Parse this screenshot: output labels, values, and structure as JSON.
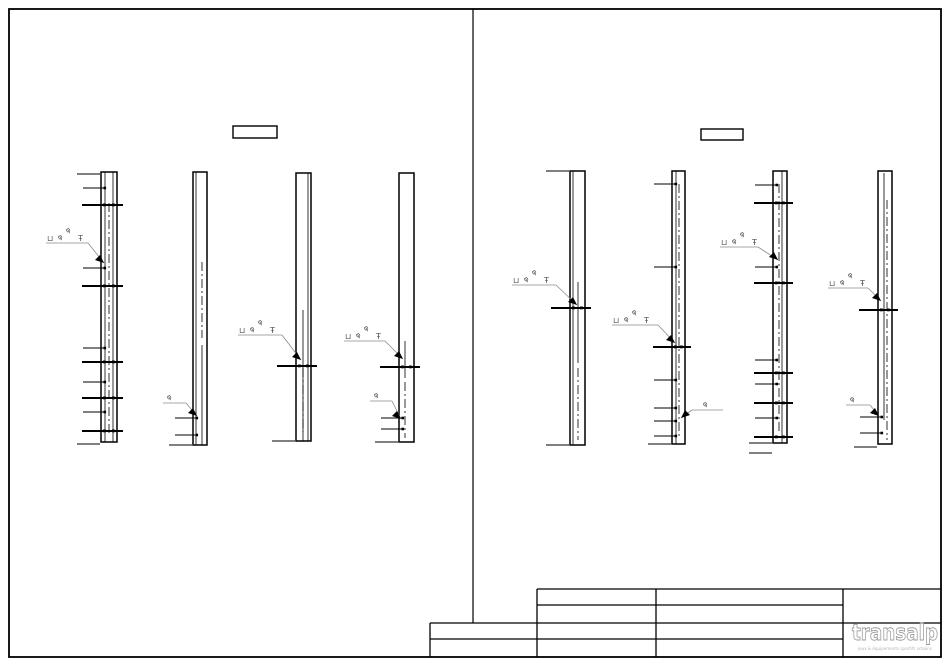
{
  "meta": {
    "sheet_name": "rebar-column-elevation-drawing"
  },
  "canvas": {
    "w": 950,
    "h": 667,
    "bg": "#ffffff",
    "ink": "#000000",
    "leader": "#8a8a8a",
    "symbol": "#565656"
  },
  "border": {
    "x": 9,
    "y": 9,
    "w": 932,
    "h": 648,
    "stroke_w": 1.8
  },
  "divider": {
    "x": 473,
    "y1": 9,
    "y2": 623
  },
  "label_boxes": [
    {
      "x": 233,
      "y": 126,
      "w": 44,
      "h": 12
    },
    {
      "x": 701,
      "y": 129,
      "w": 42,
      "h": 11
    }
  ],
  "columns": [
    {
      "x": 101,
      "w": 16,
      "top": 172,
      "bot": 442,
      "inner": [
        {
          "dx": 4,
          "y1": 172,
          "y2": 442
        },
        {
          "dx": 12,
          "y1": 172,
          "y2": 442
        }
      ],
      "center": {
        "dx": 8,
        "y1": 203,
        "y2": 436
      },
      "ticks": [
        {
          "y": 174,
          "t": "end"
        },
        {
          "y": 188,
          "t": "dot"
        },
        {
          "y": 205,
          "t": "cross"
        },
        {
          "y": 268,
          "t": "dot"
        },
        {
          "y": 286,
          "t": "cross"
        },
        {
          "y": 348,
          "t": "dot"
        },
        {
          "y": 362,
          "t": "cross"
        },
        {
          "y": 382,
          "t": "dot"
        },
        {
          "y": 398,
          "t": "cross"
        },
        {
          "y": 412,
          "t": "dot"
        },
        {
          "y": 431,
          "t": "cross"
        },
        {
          "y": 444,
          "t": "end"
        }
      ]
    },
    {
      "x": 193,
      "w": 14,
      "top": 172,
      "bot": 445,
      "inner": [
        {
          "dx": 3,
          "y1": 172,
          "y2": 445
        },
        {
          "dx": 9,
          "y1": 345,
          "y2": 445
        }
      ],
      "center": {
        "dx": 9,
        "y1": 262,
        "y2": 338
      },
      "ticks": [
        {
          "y": 418,
          "t": "dot"
        },
        {
          "y": 435,
          "t": "dot"
        },
        {
          "y": 445,
          "t": "end"
        }
      ]
    },
    {
      "x": 296,
      "w": 15,
      "top": 173,
      "bot": 441,
      "inner": [
        {
          "dx": 12,
          "y1": 173,
          "y2": 441
        },
        {
          "dx": 7,
          "y1": 310,
          "y2": 441
        }
      ],
      "center": {
        "dx": 7,
        "y1": 368,
        "y2": 432
      },
      "ticks": [
        {
          "y": 366,
          "t": "cross"
        },
        {
          "y": 441,
          "t": "end"
        }
      ]
    },
    {
      "x": 399,
      "w": 15,
      "top": 173,
      "bot": 442,
      "inner": [
        {
          "dx": 6,
          "y1": 341,
          "y2": 378
        }
      ],
      "center": {
        "dx": 6,
        "y1": 382,
        "y2": 438
      },
      "ticks": [
        {
          "y": 367,
          "t": "cross"
        },
        {
          "y": 418,
          "t": "dot"
        },
        {
          "y": 429,
          "t": "dot"
        },
        {
          "y": 442,
          "t": "end"
        }
      ]
    },
    {
      "x": 570,
      "w": 15,
      "top": 171,
      "bot": 445,
      "inner": [
        {
          "dx": 3,
          "y1": 171,
          "y2": 445
        },
        {
          "dx": 8,
          "y1": 282,
          "y2": 363
        }
      ],
      "center": {
        "dx": 8,
        "y1": 368,
        "y2": 440
      },
      "ticks": [
        {
          "y": 171,
          "t": "end"
        },
        {
          "y": 308,
          "t": "cross"
        },
        {
          "y": 445,
          "t": "end"
        }
      ]
    },
    {
      "x": 672,
      "w": 13,
      "top": 171,
      "bot": 444,
      "inner": [
        {
          "dx": 4,
          "y1": 171,
          "y2": 444
        }
      ],
      "center": {
        "dx": 7,
        "y1": 184,
        "y2": 438
      },
      "ticks": [
        {
          "y": 184,
          "t": "dot"
        },
        {
          "y": 267,
          "t": "dot"
        },
        {
          "y": 347,
          "t": "cross"
        },
        {
          "y": 380,
          "t": "dot"
        },
        {
          "y": 408,
          "t": "dot"
        },
        {
          "y": 421,
          "t": "dot"
        },
        {
          "y": 436,
          "t": "dot"
        },
        {
          "y": 444,
          "t": "end"
        }
      ]
    },
    {
      "x": 773,
      "w": 14,
      "top": 171,
      "bot": 443,
      "inner": [
        {
          "dx": 9,
          "y1": 171,
          "y2": 443
        }
      ],
      "center": {
        "dx": 6,
        "y1": 184,
        "y2": 434
      },
      "ticks": [
        {
          "y": 185,
          "t": "dot"
        },
        {
          "y": 203,
          "t": "cross"
        },
        {
          "y": 267,
          "t": "dot"
        },
        {
          "y": 283,
          "t": "cross"
        },
        {
          "y": 360,
          "t": "dot"
        },
        {
          "y": 373,
          "t": "cross"
        },
        {
          "y": 384,
          "t": "dot"
        },
        {
          "y": 403,
          "t": "cross"
        },
        {
          "y": 418,
          "t": "dot"
        },
        {
          "y": 437,
          "t": "cross"
        },
        {
          "y": 443,
          "t": "end"
        },
        {
          "y": 453,
          "t": "end"
        }
      ]
    },
    {
      "x": 878,
      "w": 14,
      "top": 171,
      "bot": 444,
      "inner": [
        {
          "dx": 6,
          "y1": 173,
          "y2": 420
        }
      ],
      "center": {
        "dx": 9,
        "y1": 200,
        "y2": 440
      },
      "ticks": [
        {
          "y": 310,
          "t": "cross"
        },
        {
          "y": 417,
          "t": "dot"
        },
        {
          "y": 433,
          "t": "dot"
        },
        {
          "y": 447,
          "t": "end"
        }
      ]
    }
  ],
  "callouts": {
    "full_symbols": [
      "⊔",
      "φ",
      "φ",
      "Ŧ"
    ],
    "phi_symbol": "φ",
    "items": [
      {
        "t": "full",
        "lx": 46,
        "ly": 243,
        "lw": 42,
        "tx": 104,
        "ty": 263,
        "dir": 1
      },
      {
        "t": "full",
        "lx": 238,
        "ly": 335,
        "lw": 44,
        "tx": 301,
        "ty": 360,
        "dir": 1
      },
      {
        "t": "full",
        "lx": 344,
        "ly": 341,
        "lw": 41,
        "tx": 403,
        "ty": 359,
        "dir": 1
      },
      {
        "t": "full",
        "lx": 512,
        "ly": 285,
        "lw": 44,
        "tx": 577,
        "ty": 305,
        "dir": 1
      },
      {
        "t": "full",
        "lx": 612,
        "ly": 325,
        "lw": 46,
        "tx": 675,
        "ty": 343,
        "dir": 1
      },
      {
        "t": "full",
        "lx": 720,
        "ly": 247,
        "lw": 38,
        "tx": 778,
        "ty": 260,
        "dir": 1
      },
      {
        "t": "full",
        "lx": 828,
        "ly": 288,
        "lw": 40,
        "tx": 881,
        "ty": 301,
        "dir": 1
      },
      {
        "t": "phi",
        "lx": 163,
        "ly": 403,
        "lw": 23,
        "tx": 197,
        "ty": 416,
        "dir": 1
      },
      {
        "t": "phi",
        "lx": 370,
        "ly": 401,
        "lw": 22,
        "tx": 401,
        "ty": 419,
        "dir": 1
      },
      {
        "t": "phi",
        "lx": 692,
        "ly": 410,
        "lw": 31,
        "tx": 681,
        "ty": 418,
        "dir": -1
      },
      {
        "t": "phi",
        "lx": 846,
        "ly": 405,
        "lw": 24,
        "tx": 879,
        "ty": 416,
        "dir": 1
      }
    ]
  },
  "title_block": {
    "h_lines": [
      {
        "x1": 537,
        "x2": 941,
        "y": 589
      },
      {
        "x1": 537,
        "x2": 843,
        "y": 605
      },
      {
        "x1": 430,
        "x2": 941,
        "y": 623
      },
      {
        "x1": 430,
        "x2": 843,
        "y": 639
      }
    ],
    "v_lines": [
      {
        "x": 430,
        "y1": 623,
        "y2": 657
      },
      {
        "x": 537,
        "y1": 589,
        "y2": 657
      },
      {
        "x": 656,
        "y1": 589,
        "y2": 657
      },
      {
        "x": 843,
        "y1": 589,
        "y2": 657
      }
    ]
  },
  "logo": {
    "text": "transalp",
    "tagline": "jeux & équipements sportifs urbains",
    "color": "#9b9b9b",
    "tagline_color": "#b4b4b4",
    "x": 852,
    "y": 640,
    "tagline_y": 650
  }
}
